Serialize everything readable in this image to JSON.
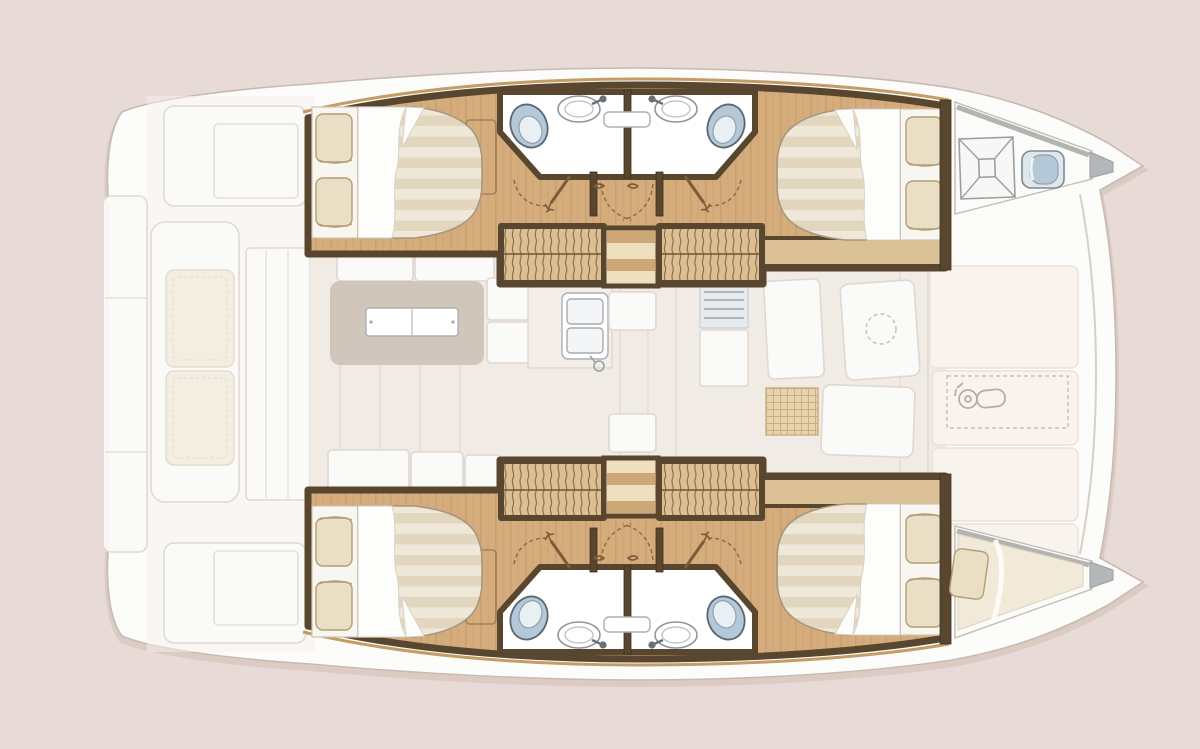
{
  "meta": {
    "title": "Catamaran interior layout plan",
    "view": "top-down floor plan",
    "bow_direction": "right",
    "style": "rendered yacht layout drawing, no text labels"
  },
  "colors": {
    "background": "#e8dad6",
    "boat_white": "#fcfcfa",
    "boat_outline": "#c7bab1",
    "boat_shadow": "#cbb7ae",
    "deck_faded": "#f5f1ed",
    "faded_floor": "#f1ebe5",
    "faded_panel": "#fafaf8",
    "faded_panel_stroke": "#e0d8d0",
    "cushion_cream": "#f4eee1",
    "cushion_stroke": "#e4dac8",
    "table_taupe": "#cbbfb4",
    "appliance_gray": "#e8ebed",
    "appliance_line": "#9aa3aa",
    "mat_weave": "#e7d4ae",
    "mat_line": "#c9ad7c",
    "wood_floor": "#d5ac7c",
    "wood_plank": "#bf9765",
    "wood_light": "#dcc096",
    "dark_wood": "#59462e",
    "dark_wood_edge": "#3e301d",
    "gunwale_tan": "#c49c66",
    "wardrobe_fill": "#dcc093",
    "wardrobe_line": "#6f5434",
    "mattress_a": "#efe8d9",
    "mattress_b": "#e2d6bf",
    "mattress_stroke": "#a69780",
    "duvet_white": "#fdfdfb",
    "pillow_fill": "#eadfc4",
    "pillow_stroke": "#b39d76",
    "headboard_white": "#f8f6f1",
    "toilet_body": "#b5c8d7",
    "toilet_stroke": "#5a6672",
    "toilet_lid": "#e9f0f4",
    "sink_fill": "#ffffff",
    "sink_stroke": "#8f969b",
    "door_brown": "#7c5c38",
    "step_light": "#eedfbf",
    "step_dark": "#cda876",
    "trim_gray": "#b3b3b1",
    "hatch_line": "#9aa0a2",
    "dash_gray": "#c6bfb6",
    "windlass_gray": "#b5afa8"
  },
  "layout": {
    "hulls": [
      {
        "id": "hull-top",
        "position": "top",
        "rooms": [
          {
            "name": "aft-cabin",
            "furniture": [
              "double-bed",
              "two-pillows",
              "white-duvet",
              "floor-hatch"
            ]
          },
          {
            "name": "bathroom-aft",
            "fixtures": [
              "marine-toilet",
              "oval-washbasin",
              "hinged-door-with-swing-arc"
            ]
          },
          {
            "name": "bathroom-forward",
            "fixtures": [
              "marine-toilet",
              "oval-washbasin",
              "hinged-door-with-swing-arc"
            ]
          },
          {
            "name": "hanging-wardrobe-aft"
          },
          {
            "name": "companionway-steps"
          },
          {
            "name": "hanging-wardrobe-forward"
          },
          {
            "name": "forward-cabin",
            "furniture": [
              "double-bed",
              "two-pillows",
              "white-duvet",
              "side-shelf"
            ]
          },
          {
            "name": "forepeak",
            "fixtures": [
              "deck-hatch-x-brace",
              "washbasin-unit",
              "bow-chock"
            ]
          }
        ]
      },
      {
        "id": "hull-bottom",
        "position": "bottom",
        "mirrored_from": "hull-top",
        "rooms": [
          {
            "name": "aft-cabin",
            "furniture": [
              "double-bed",
              "two-pillows",
              "white-duvet",
              "floor-hatch"
            ]
          },
          {
            "name": "bathroom-aft",
            "fixtures": [
              "marine-toilet",
              "oval-washbasin",
              "hinged-door-with-swing-arc"
            ]
          },
          {
            "name": "bathroom-forward",
            "fixtures": [
              "marine-toilet",
              "oval-washbasin",
              "hinged-door-with-swing-arc"
            ]
          },
          {
            "name": "hanging-wardrobe-aft"
          },
          {
            "name": "companionway-steps"
          },
          {
            "name": "hanging-wardrobe-forward"
          },
          {
            "name": "forward-cabin",
            "furniture": [
              "double-bed",
              "two-pillows",
              "white-duvet",
              "side-shelf"
            ]
          },
          {
            "name": "forepeak-berth",
            "furniture": [
              "single-berth",
              "one-pillow",
              "bow-chock"
            ]
          }
        ]
      }
    ],
    "saloon": {
      "rendering": "faded overlay",
      "furniture": [
        "sofa-top-cushions",
        "sofa-side-cushions",
        "saloon-table-with-folding-top",
        "galley-double-sink",
        "galley-faucet",
        "appliance-stack",
        "forward-lounge-panels",
        "dashed-round-table",
        "woven-mat",
        "aft-sofa-cushions",
        "companionway-landings"
      ]
    },
    "cockpit": {
      "rendering": "faded overlay",
      "furniture": [
        "transom-platform",
        "cockpit-bench-two-cushions",
        "aft-deck-box-top",
        "aft-deck-box-bottom",
        "saloon-aft-sliding-door"
      ]
    },
    "foredeck": {
      "rendering": "faded overlay",
      "features": [
        "sunpad-panel-rows",
        "dashed-service-outline",
        "anchor-windlass",
        "forward-crossbeam"
      ]
    }
  }
}
